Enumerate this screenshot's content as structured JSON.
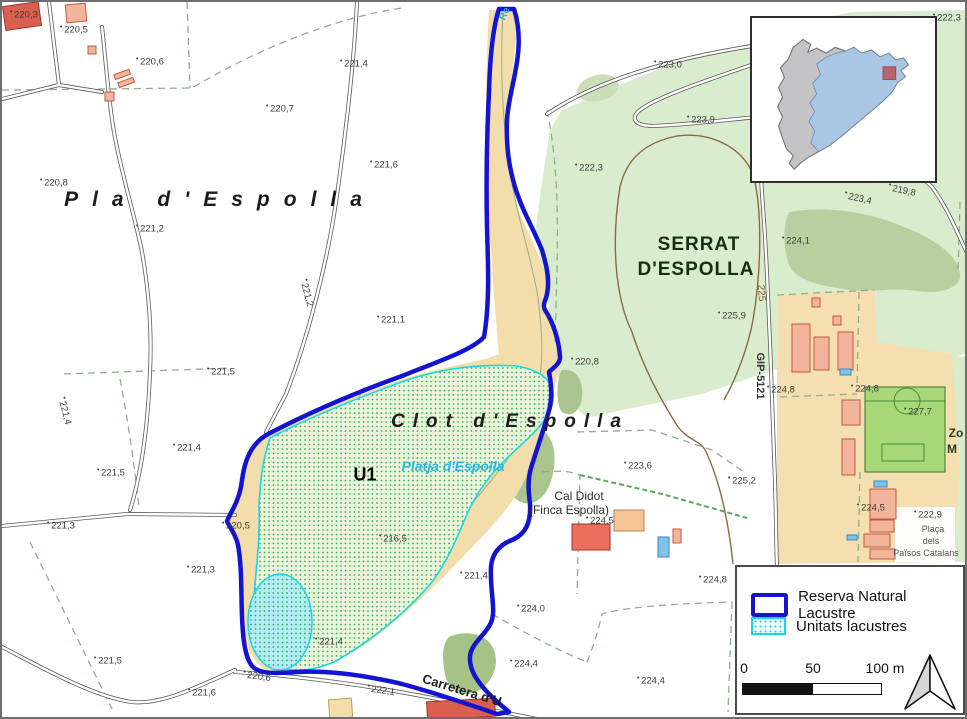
{
  "title": "Reserva Natural Lacustre - Clot d'Espolla",
  "colors": {
    "reserve_boundary": "#1313d0",
    "lacustrine_border": "#14d8e6",
    "lacustrine_fill": "#e9f4da",
    "water_fill": "#b2ecf4",
    "vegetation": "#d9ecce",
    "forest": "#b8cfa0",
    "bare_soil": "#f3deab",
    "building": "#f2b49a",
    "inset_region": "#a9c7e4",
    "inset_marker": "#b9636f"
  },
  "legend": {
    "items": [
      {
        "label": "Reserva Natural Lacustre",
        "swatch": "reserve-boundary"
      },
      {
        "label": "Unitats lacustres",
        "swatch": "lacustrine-units"
      }
    ],
    "scale_ticks": [
      "0",
      "50",
      "100 m"
    ]
  },
  "map": {
    "place_labels": [
      {
        "text": "Pla d'Espolla",
        "x": 218,
        "y": 198,
        "cls": "toponym-pla",
        "name": "label-pla-despolla"
      },
      {
        "text": "Clot d'Espolla",
        "x": 508,
        "y": 420,
        "cls": "toponym-clot",
        "name": "label-clot-despolla"
      },
      {
        "text": "SERRAT",
        "x": 697,
        "y": 243,
        "cls": "toponym-serrat",
        "name": "label-serrat"
      },
      {
        "text": "D'ESPOLLA",
        "x": 694,
        "y": 268,
        "cls": "toponym-serrat",
        "name": "label-serrat-2"
      },
      {
        "text": "U1",
        "x": 363,
        "y": 473,
        "cls": "unit-label",
        "name": "label-u1"
      },
      {
        "text": "Platja d'Espolla",
        "x": 451,
        "y": 464,
        "cls": "water-label",
        "name": "label-platja"
      },
      {
        "text": "Cal Didot",
        "x": 577,
        "y": 494,
        "cls": "farm-label",
        "name": "label-cal-didot"
      },
      {
        "text": "(Finca Espolla)",
        "x": 567,
        "y": 508,
        "cls": "farm-label",
        "name": "label-finca-espolla"
      },
      {
        "text": "Carretera d'U",
        "x": 460,
        "y": 688,
        "rot": 17,
        "cls": "road-label",
        "name": "label-carretera"
      },
      {
        "text": "GIP-5121",
        "x": 758,
        "y": 374,
        "rot": 90,
        "cls": "road-ref",
        "name": "label-gip-5121"
      },
      {
        "text": "225",
        "x": 759,
        "y": 291,
        "rot": 86,
        "cls": "contour-label",
        "name": "label-contour-225"
      },
      {
        "text": "Re",
        "x": 503,
        "y": 12,
        "rot": -65,
        "cls": "stream-label",
        "name": "label-stream"
      },
      {
        "text": "Zo",
        "x": 954,
        "y": 431,
        "cls": "zone-label",
        "name": "label-zona-1"
      },
      {
        "text": "M",
        "x": 950,
        "y": 447,
        "cls": "zone-label",
        "name": "label-zona-2"
      },
      {
        "text": "Plaça",
        "x": 931,
        "y": 527,
        "cls": "placa-label",
        "name": "label-placa-1"
      },
      {
        "text": "dels",
        "x": 929,
        "y": 539,
        "cls": "placa-label",
        "name": "label-placa-2"
      },
      {
        "text": "Països Catalans",
        "x": 924,
        "y": 551,
        "cls": "placa-label",
        "name": "label-placa-3"
      }
    ],
    "elevation_labels": [
      {
        "text": "220,3",
        "x": 24,
        "y": 13
      },
      {
        "text": "220,5",
        "x": 74,
        "y": 28
      },
      {
        "text": "220,6",
        "x": 150,
        "y": 60
      },
      {
        "text": "220,7",
        "x": 280,
        "y": 107
      },
      {
        "text": "221,4",
        "x": 354,
        "y": 62
      },
      {
        "text": "221,6",
        "x": 384,
        "y": 163
      },
      {
        "text": "220,8",
        "x": 54,
        "y": 181
      },
      {
        "text": "221,2",
        "x": 150,
        "y": 227
      },
      {
        "text": "221,2",
        "x": 305,
        "y": 293,
        "rot": 75
      },
      {
        "text": "221,1",
        "x": 391,
        "y": 318
      },
      {
        "text": "222,3",
        "x": 589,
        "y": 166
      },
      {
        "text": "223,0",
        "x": 668,
        "y": 63
      },
      {
        "text": "223,9",
        "x": 701,
        "y": 118
      },
      {
        "text": "222,3",
        "x": 947,
        "y": 16
      },
      {
        "text": "223,4",
        "x": 858,
        "y": 197,
        "rot": 12
      },
      {
        "text": "219,8",
        "x": 902,
        "y": 189,
        "rot": 12
      },
      {
        "text": "224,1",
        "x": 796,
        "y": 239
      },
      {
        "text": "225,9",
        "x": 732,
        "y": 314
      },
      {
        "text": "220,8",
        "x": 585,
        "y": 360
      },
      {
        "text": "223,6",
        "x": 638,
        "y": 464
      },
      {
        "text": "225,2",
        "x": 742,
        "y": 479
      },
      {
        "text": "221,5",
        "x": 221,
        "y": 370
      },
      {
        "text": "221,4",
        "x": 63,
        "y": 411,
        "rot": 75
      },
      {
        "text": "221,4",
        "x": 187,
        "y": 446
      },
      {
        "text": "221,5",
        "x": 111,
        "y": 471
      },
      {
        "text": "221,3",
        "x": 61,
        "y": 524
      },
      {
        "text": "220,5",
        "x": 236,
        "y": 524
      },
      {
        "text": "221,3",
        "x": 201,
        "y": 568
      },
      {
        "text": "216,5",
        "x": 393,
        "y": 537
      },
      {
        "text": "221,4",
        "x": 474,
        "y": 574
      },
      {
        "text": "221,5",
        "x": 108,
        "y": 659
      },
      {
        "text": "221,6",
        "x": 202,
        "y": 691
      },
      {
        "text": "220,6",
        "x": 257,
        "y": 675,
        "rot": 8
      },
      {
        "text": "221,4",
        "x": 329,
        "y": 640
      },
      {
        "text": "222,1",
        "x": 381,
        "y": 689,
        "rot": 8
      },
      {
        "text": "224,0",
        "x": 531,
        "y": 607
      },
      {
        "text": "224,4",
        "x": 524,
        "y": 662
      },
      {
        "text": "224,4",
        "x": 651,
        "y": 679
      },
      {
        "text": "224,8",
        "x": 713,
        "y": 578
      },
      {
        "text": "224,5",
        "x": 600,
        "y": 519
      },
      {
        "text": "224,8",
        "x": 781,
        "y": 388
      },
      {
        "text": "224,8",
        "x": 865,
        "y": 387
      },
      {
        "text": "227,7",
        "x": 918,
        "y": 410
      },
      {
        "text": "224,5",
        "x": 871,
        "y": 506
      },
      {
        "text": "222,9",
        "x": 928,
        "y": 513
      }
    ]
  }
}
